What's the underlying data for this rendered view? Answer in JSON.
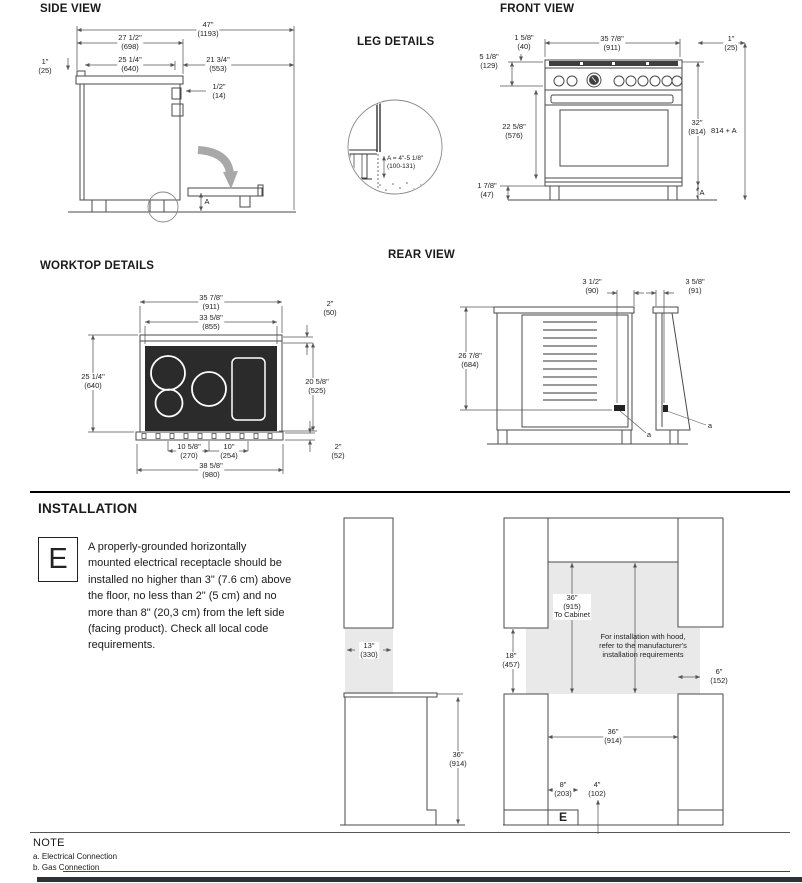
{
  "titles": {
    "side_view": "SIDE VIEW",
    "front_view": "FRONT VIEW",
    "leg_details": "LEG DETAILS",
    "worktop_details": "WORKTOP DETAILS",
    "rear_view": "REAR VIEW",
    "installation": "INSTALLATION",
    "note": "NOTE"
  },
  "side_view": {
    "dim_total_depth": {
      "in": "47\"",
      "mm": "(1193)"
    },
    "dim_depth_698": {
      "in": "27 1/2\"",
      "mm": "(698)"
    },
    "dim_back_offset": {
      "in": "1\"",
      "mm": "(25)"
    },
    "dim_depth_640": {
      "in": "25 1/4\"",
      "mm": "(640)"
    },
    "dim_door_553": {
      "in": "21 3/4\"",
      "mm": "(553)"
    },
    "dim_gap_14": {
      "in": "1/2\"",
      "mm": "(14)"
    },
    "leg_height_label": "A"
  },
  "front_view": {
    "dim_back_trim": {
      "in": "1 5/8\"",
      "mm": "(40)"
    },
    "dim_width": {
      "in": "35 7/8\"",
      "mm": "(911)"
    },
    "dim_side_offset": {
      "in": "1\"",
      "mm": "(25)"
    },
    "dim_backguard": {
      "in": "5 1/8\"",
      "mm": "(129)"
    },
    "dim_door_height": {
      "in": "22 5/8\"",
      "mm": "(576)"
    },
    "dim_height": {
      "in": "32\"",
      "mm": "(814)"
    },
    "height_plus_leg": "814 + A",
    "dim_leg": {
      "in": "1 7/8\"",
      "mm": "(47)"
    },
    "leg_height_label": "A"
  },
  "leg_details": {
    "range_line1": "A = 4\"-5 1/8\"",
    "range_line2": "(100-131)"
  },
  "worktop": {
    "dim_width_911": {
      "in": "35 7/8\"",
      "mm": "(911)"
    },
    "dim_width_855": {
      "in": "33 5/8\"",
      "mm": "(855)"
    },
    "dim_rim_50": {
      "in": "2\"",
      "mm": "(50)"
    },
    "dim_depth_640": {
      "in": "25 1/4\"",
      "mm": "(640)"
    },
    "dim_panel_525": {
      "in": "20 5/8\"",
      "mm": "(525)"
    },
    "dim_burner_270": {
      "in": "10 5/8\"",
      "mm": "(270)"
    },
    "dim_burner_254": {
      "in": "10\"",
      "mm": "(254)"
    },
    "dim_base_52": {
      "in": "2\"",
      "mm": "(52)"
    },
    "dim_width_980": {
      "in": "38 5/8\"",
      "mm": "(980)"
    }
  },
  "rear_view": {
    "dim_elec_90": {
      "in": "3 1/2\"",
      "mm": "(90)"
    },
    "dim_side_91": {
      "in": "3 5/8\"",
      "mm": "(91)"
    },
    "dim_height_684": {
      "in": "26 7/8\"",
      "mm": "(684)"
    },
    "label_a_rear": "a",
    "label_a_side": "a"
  },
  "installation": {
    "symbol": "E",
    "text": "A properly-grounded horizontally\nmounted electrical receptacle should be\ninstalled no higher than 3\" (7.6 cm) above\nthe floor, no less than 2\" (5 cm) and no\nmore than 8\" (20,3 cm) from the left side\n(facing product). Check all local code\nrequirements.",
    "left": {
      "dim_cabinet_330": {
        "in": "13\"",
        "mm": "(330)"
      },
      "dim_counter_914": {
        "in": "36\"",
        "mm": "(914)"
      }
    },
    "right": {
      "dim_to_cabinet": {
        "in": "36\"",
        "mm": "(915)",
        "note": "To Cabinet"
      },
      "hood_note": "For installation with hood,\nrefer to the manufacturer's\ninstallation requirements",
      "dim_457": {
        "in": "18\"",
        "mm": "(457)"
      },
      "dim_152": {
        "in": "6\"",
        "mm": "(152)"
      },
      "dim_opening_914": {
        "in": "36\"",
        "mm": "(914)"
      },
      "dim_outlet_203": {
        "in": "8\"",
        "mm": "(203)"
      },
      "dim_gas_102": {
        "in": "4\"",
        "mm": "(102)"
      },
      "symbol": "E"
    }
  },
  "note": {
    "items": [
      "a. Electrical Connection",
      "b. Gas Connection"
    ]
  },
  "colors": {
    "line": "#4a4a4a",
    "cooktop": "#2b2b2b",
    "shade": "#e9e9e9",
    "footer_bar": "#2d3138"
  }
}
